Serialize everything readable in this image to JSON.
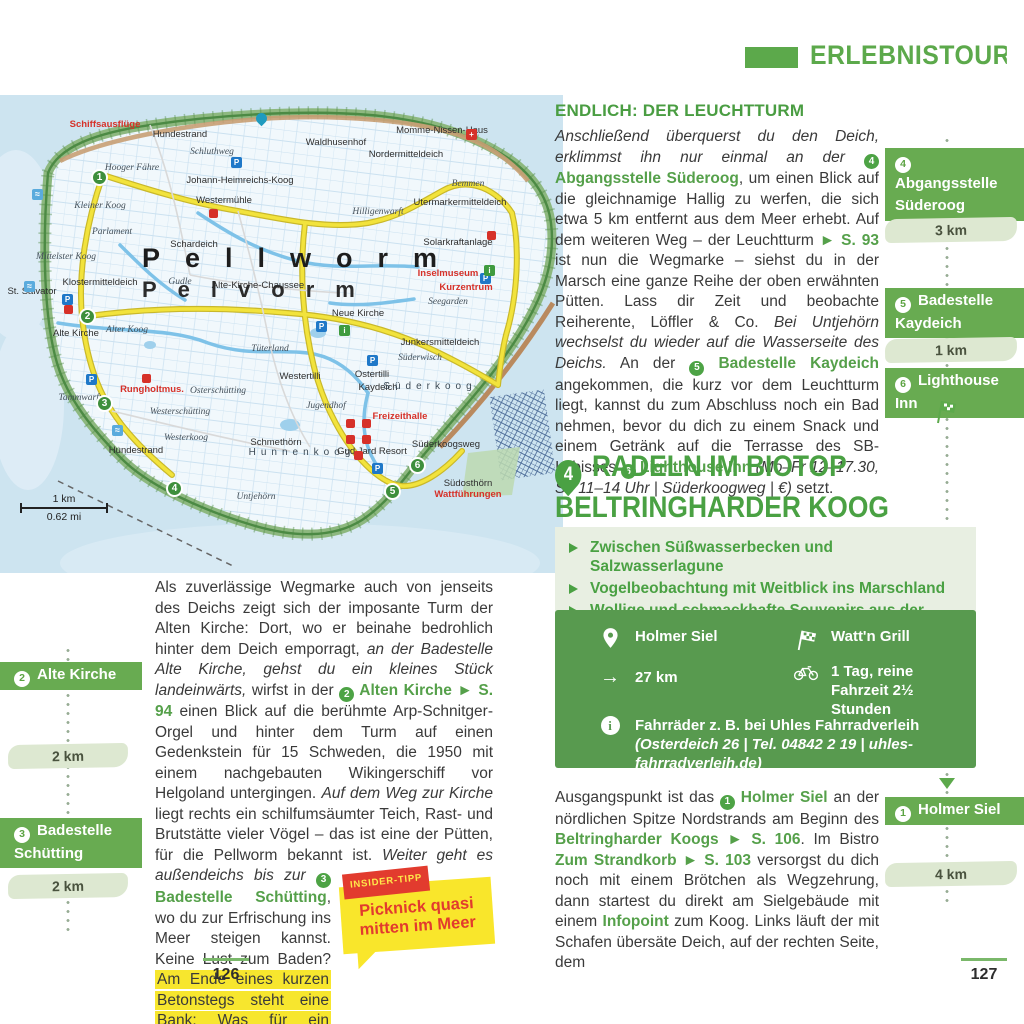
{
  "colors": {
    "accent_green": "#5ca94b",
    "banner_green": "#68ab51",
    "box_green": "#589a4f",
    "wash_green": "#dde8d1",
    "highlight_yellow": "#f7e62e",
    "tip_yellow": "#f9e62b",
    "red": "#e23b2e"
  },
  "header": {
    "banner_title": "ERLEBNISTOUREN I"
  },
  "tour_badge": "3",
  "map": {
    "big_label_line1": "Pellworm",
    "big_label_line2": "Pelvorm",
    "scale_km": "1 km",
    "scale_mi": "0.62 mi",
    "labels": [
      {
        "t": "Schiffsausflüge",
        "x": 105,
        "y": 30,
        "c": "red"
      },
      {
        "t": "Hundestrand",
        "x": 180,
        "y": 40
      },
      {
        "t": "Hooger Fähre",
        "x": 132,
        "y": 74,
        "c": "it"
      },
      {
        "t": "Schluthweg",
        "x": 212,
        "y": 58,
        "c": "it"
      },
      {
        "t": "Johann-Heimreichs-Koog",
        "x": 240,
        "y": 86
      },
      {
        "t": "Kleiner Koog",
        "x": 100,
        "y": 112,
        "c": "it"
      },
      {
        "t": "Westermühle",
        "x": 224,
        "y": 106
      },
      {
        "t": "Parlament",
        "x": 112,
        "y": 138,
        "c": "it"
      },
      {
        "t": "Schardeich",
        "x": 194,
        "y": 150
      },
      {
        "t": "Mittelster Koog",
        "x": 66,
        "y": 163,
        "c": "it"
      },
      {
        "t": "Klostermitteldeich",
        "x": 100,
        "y": 188
      },
      {
        "t": "St. Salvator",
        "x": 32,
        "y": 197
      },
      {
        "t": "Gudle",
        "x": 180,
        "y": 188,
        "c": "it"
      },
      {
        "t": "Alte-Kirche-Chaussee",
        "x": 258,
        "y": 191
      },
      {
        "t": "Alte Kirche",
        "x": 76,
        "y": 239
      },
      {
        "t": "Alter Koog",
        "x": 127,
        "y": 236,
        "c": "it"
      },
      {
        "t": "Tüterland",
        "x": 270,
        "y": 255,
        "c": "it"
      },
      {
        "t": "Tammwarft",
        "x": 80,
        "y": 304,
        "c": "it"
      },
      {
        "t": "Hundestrand",
        "x": 136,
        "y": 356
      },
      {
        "t": "Rungholtmus.",
        "x": 152,
        "y": 295,
        "c": "red"
      },
      {
        "t": "Waldhusenhof",
        "x": 336,
        "y": 48
      },
      {
        "t": "Nordermitteldeich",
        "x": 406,
        "y": 60
      },
      {
        "t": "Momme-Nissen-Haus",
        "x": 442,
        "y": 36
      },
      {
        "t": "Hilligenwarft",
        "x": 378,
        "y": 118,
        "c": "it"
      },
      {
        "t": "Bemmen",
        "x": 468,
        "y": 90,
        "c": "it"
      },
      {
        "t": "Utermarkermitteldeich",
        "x": 460,
        "y": 108
      },
      {
        "t": "Solarkraftanlage",
        "x": 458,
        "y": 148
      },
      {
        "t": "Inselmuseum",
        "x": 448,
        "y": 179,
        "c": "red"
      },
      {
        "t": "Kurzentrum",
        "x": 466,
        "y": 193,
        "c": "red"
      },
      {
        "t": "Seegarden",
        "x": 448,
        "y": 208,
        "c": "it"
      },
      {
        "t": "Neue Kirche",
        "x": 358,
        "y": 219
      },
      {
        "t": "Junkersmitteldeich",
        "x": 440,
        "y": 248
      },
      {
        "t": "Süderwisch",
        "x": 420,
        "y": 264,
        "c": "it"
      },
      {
        "t": "Westertilli",
        "x": 300,
        "y": 282
      },
      {
        "t": "Ostertilli",
        "x": 372,
        "y": 280
      },
      {
        "t": "Kaydeich",
        "x": 378,
        "y": 293
      },
      {
        "t": "Osterschütting",
        "x": 218,
        "y": 297,
        "c": "it"
      },
      {
        "t": "Westerschütting",
        "x": 180,
        "y": 318,
        "c": "it"
      },
      {
        "t": "Jugendhof",
        "x": 326,
        "y": 312,
        "c": "it"
      },
      {
        "t": "Freizeithalle",
        "x": 400,
        "y": 322,
        "c": "red"
      },
      {
        "t": "Süderkoog",
        "x": 430,
        "y": 292,
        "c": "sp"
      },
      {
        "t": "Westerkoog",
        "x": 186,
        "y": 344,
        "c": "it"
      },
      {
        "t": "Schmethörn",
        "x": 276,
        "y": 348
      },
      {
        "t": "Hunnenkoog",
        "x": 302,
        "y": 358,
        "c": "sp"
      },
      {
        "t": "Gud Jard Resort",
        "x": 372,
        "y": 357
      },
      {
        "t": "Süderkoogsweg",
        "x": 446,
        "y": 350
      },
      {
        "t": "Untjehörn",
        "x": 256,
        "y": 403,
        "c": "it"
      },
      {
        "t": "Südosthörn",
        "x": 468,
        "y": 389
      },
      {
        "t": "Wattführungen",
        "x": 468,
        "y": 400,
        "c": "red"
      }
    ],
    "route_markers": [
      {
        "n": "1",
        "x": 100,
        "y": 83
      },
      {
        "n": "2",
        "x": 88,
        "y": 222
      },
      {
        "n": "3",
        "x": 105,
        "y": 309
      },
      {
        "n": "4",
        "x": 175,
        "y": 394
      },
      {
        "n": "5",
        "x": 393,
        "y": 397
      },
      {
        "n": "6",
        "x": 418,
        "y": 371
      }
    ],
    "icons": [
      {
        "k": "parking",
        "x": 237,
        "y": 68
      },
      {
        "k": "parking",
        "x": 68,
        "y": 205
      },
      {
        "k": "parking",
        "x": 92,
        "y": 285
      },
      {
        "k": "parking",
        "x": 322,
        "y": 232
      },
      {
        "k": "parking",
        "x": 373,
        "y": 266
      },
      {
        "k": "parking",
        "x": 486,
        "y": 184
      },
      {
        "k": "parking",
        "x": 378,
        "y": 374
      },
      {
        "k": "info",
        "x": 345,
        "y": 236
      },
      {
        "k": "info",
        "x": 490,
        "y": 176
      },
      {
        "k": "red",
        "x": 215,
        "y": 120
      },
      {
        "k": "red",
        "x": 70,
        "y": 216
      },
      {
        "k": "red",
        "x": 148,
        "y": 285
      },
      {
        "k": "red",
        "x": 493,
        "y": 142
      },
      {
        "k": "red",
        "x": 352,
        "y": 330
      },
      {
        "k": "red",
        "x": 368,
        "y": 330
      },
      {
        "k": "red",
        "x": 352,
        "y": 346
      },
      {
        "k": "red",
        "x": 368,
        "y": 346
      },
      {
        "k": "red",
        "x": 360,
        "y": 362
      },
      {
        "k": "cross",
        "x": 472,
        "y": 40
      },
      {
        "k": "swim",
        "x": 38,
        "y": 100
      },
      {
        "k": "swim",
        "x": 30,
        "y": 192
      },
      {
        "k": "swim",
        "x": 118,
        "y": 336
      },
      {
        "k": "pin",
        "x": 262,
        "y": 28
      }
    ]
  },
  "left_page": {
    "sidebar": {
      "stations": [
        {
          "num": "2",
          "label": "Alte Kirche"
        },
        {
          "num": "3",
          "label": "Badestelle Schütting"
        }
      ],
      "distances": [
        "2 km",
        "2 km"
      ]
    },
    "paragraph": [
      {
        "t": "Als zuverlässige Wegmarke auch von jenseits des Deichs zeigt sich der imposante Turm der Alten Kirche: Dort, wo er beinahe bedrohlich hinter dem Deich emporragt, "
      },
      {
        "t": "an der Badestelle Alte Kirche, gehst du ein kleines Stück landeinwärts,",
        "s": "i"
      },
      {
        "t": " wirfst in der "
      },
      {
        "t": "2",
        "s": "m"
      },
      {
        "t": " Alten Kirche ► S. 94",
        "s": "g"
      },
      {
        "t": " einen Blick auf die berühmte Arp-Schnitger-Orgel und hinter dem Turm auf einen Gedenkstein für 15 Schweden, die 1950 mit einem nachgebauten Wikingerschiff vor Helgoland untergingen. "
      },
      {
        "t": "Auf dem Weg zur Kirche",
        "s": "i"
      },
      {
        "t": " liegt rechts ein schilfumsäumter Teich, Rast- und Brutstätte vieler Vögel – das ist eine der Pütten, für die Pellworm bekannt ist. "
      },
      {
        "k": "tip"
      },
      {
        "t": "Weiter geht es außendeichs bis zur ",
        "s": "i"
      },
      {
        "t": "3",
        "s": "m"
      },
      {
        "t": " Badestelle Schütting",
        "s": "g"
      },
      {
        "t": ", wo du zur Erfrischung ins Meer steigen kannst. Keine Lust zum Baden? "
      },
      {
        "t": "Am Ende eines kurzen Betonstegs steht eine Bank: Was für ein aussichtsreiches Plätzchen, um eine kleine Stärkung einzunehmen!",
        "s": "hl"
      }
    ],
    "insider_tip": {
      "tag": "INSIDER-TIPP",
      "text": "Picknick quasi mitten im Meer"
    },
    "page_number": "126"
  },
  "right_page": {
    "heading": "ENDLICH: DER LEUCHTTURM",
    "paragraph1": [
      {
        "t": "Anschließend überquerst du den Deich, erklimmst ihn nur einmal an der ",
        "s": "i"
      },
      {
        "t": "4",
        "s": "m"
      },
      {
        "t": " Abgangsstelle Süderoog",
        "s": "g"
      },
      {
        "t": ", um einen Blick auf die gleichnamige Hallig zu werfen, die sich etwa 5 km entfernt aus dem Meer erhebt. Auf dem weiteren Weg – der Leuchtturm "
      },
      {
        "t": "► S. 93",
        "s": "g"
      },
      {
        "t": " ist nun die Wegmarke – siehst du in der Marsch eine ganze Reihe der oben erwähnten Pütten. Lass dir Zeit und beobachte Reiherente, Löffler & Co. "
      },
      {
        "t": "Bei Untjehörn wechselst du wieder auf die Wasserseite des Deichs.",
        "s": "i"
      },
      {
        "t": " An der "
      },
      {
        "t": "5",
        "s": "m"
      },
      {
        "t": " Badestelle Kaydeich",
        "s": "g"
      },
      {
        "t": " angekommen, die kurz vor dem Leuchtturm liegt, kannst du zum Abschluss noch ein Bad nehmen, bevor du dich zu einem Snack und einem Getränk auf die Terrasse des SB-Imbisses "
      },
      {
        "t": "6",
        "s": "m"
      },
      {
        "t": " Lighthouse Inn",
        "s": "g"
      },
      {
        "t": " (Mo–Fr 12–17.30, So 11–14 Uhr | Süderkoogweg | €)",
        "s": "i"
      },
      {
        "t": " setzt."
      }
    ],
    "section": {
      "number": "4",
      "title_line1": "RADELN IM BIOTOP",
      "title_line2": "BELTRINGHARDER KOOG",
      "bullets": [
        "Zwischen Süßwasserbecken und Salzwasserlagune",
        "Vogelbeobachtung mit Weitblick ins Marschland",
        "Wollige und schmackhafte Souvenirs aus der Schäferei"
      ]
    },
    "infobox": {
      "start_icon": "location-pin",
      "finish_icon": "checkered-flag",
      "distance_icon": "arrow-right",
      "duration_icon": "bicycle",
      "note_icon": "info-circle",
      "start": "Holmer Siel",
      "finish": "Watt'n Grill",
      "distance": "27 km",
      "duration": "1 Tag, reine Fahrzeit 2½ Stunden",
      "info": [
        {
          "t": "Fahrräder z. B. bei Uhles Fahrradverleih "
        },
        {
          "t": "(Osterdeich 26 | Tel. 04842 2 19 | uhles-fahrradverleih.de)",
          "s": "i"
        }
      ]
    },
    "paragraph2": [
      {
        "t": "Ausgangspunkt ist das "
      },
      {
        "t": "1",
        "s": "m"
      },
      {
        "t": " Holmer Siel",
        "s": "g"
      },
      {
        "t": " an der nördlichen Spitze Nordstrands am Beginn des "
      },
      {
        "t": "Beltringharder Koogs ► S. 106",
        "s": "g"
      },
      {
        "t": ". Im Bistro "
      },
      {
        "t": "Zum Strandkorb ► S. 103",
        "s": "g"
      },
      {
        "t": " versorgst du dich noch mit einem Brötchen als Wegzehrung, dann startest du direkt am Sielgebäude mit einem "
      },
      {
        "t": "Infopoint",
        "s": "g"
      },
      {
        "t": " zum Koog. Links läuft der mit Schafen übersäte Deich, auf der rechten Seite, dem"
      }
    ],
    "sidebar": {
      "stations": [
        {
          "num": "4",
          "label": "Abgangsstelle Süderoog"
        },
        {
          "num": "5",
          "label": "Badestelle Kaydeich"
        },
        {
          "num": "6",
          "label": "Lighthouse Inn"
        },
        {
          "num": "1",
          "label": "Holmer Siel"
        }
      ],
      "distances": [
        "3 km",
        "1 km",
        "4 km"
      ]
    },
    "page_number": "127"
  }
}
